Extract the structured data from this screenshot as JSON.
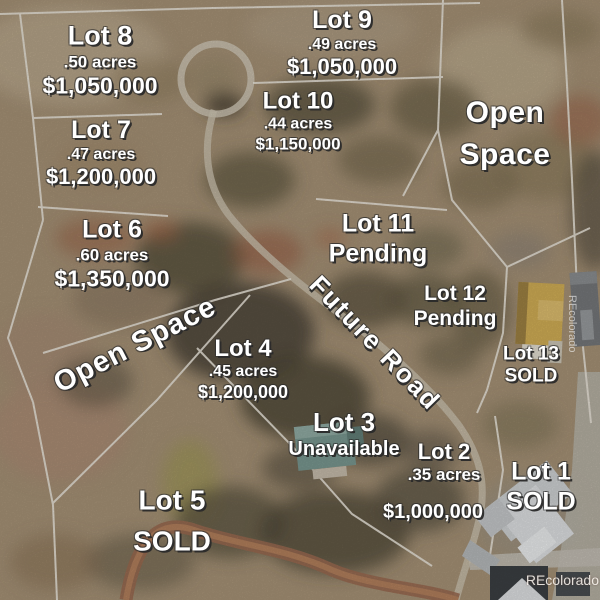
{
  "map": {
    "lots": [
      {
        "label": "Lot 8",
        "detail": ".50 acres",
        "price": "$1,050,000"
      },
      {
        "label": "Lot 9",
        "detail": ".49 acres",
        "price": "$1,050,000"
      },
      {
        "label": "Lot 10",
        "detail": ".44 acres",
        "price": "$1,150,000"
      },
      {
        "label": "Lot 7",
        "detail": ".47 acres",
        "price": "$1,200,000"
      },
      {
        "label": "Lot 6",
        "detail": ".60 acres",
        "price": "$1,350,000"
      },
      {
        "label": "Lot 11",
        "detail": "Pending",
        "price": ""
      },
      {
        "label": "Lot 12",
        "detail": "Pending",
        "price": ""
      },
      {
        "label": "Lot 13",
        "detail": "SOLD",
        "price": ""
      },
      {
        "label": "Lot 4",
        "detail": ".45 acres",
        "price": "$1,200,000"
      },
      {
        "label": "Lot 3",
        "detail": "Unavailable",
        "price": ""
      },
      {
        "label": "Lot 2",
        "detail": ".35 acres",
        "price": "$1,000,000"
      },
      {
        "label": "Lot 1",
        "detail": "SOLD",
        "price": ""
      },
      {
        "label": "Lot 5",
        "detail": "SOLD",
        "price": ""
      }
    ],
    "open_space_top_right": "Open Space",
    "open_space_left": "Open Space",
    "future_road_label": "Future Road",
    "watermark": "REcolorado",
    "colors": {
      "label_text": "#ffffff",
      "label_shadow": "#2a2a2a",
      "boundary_line": "#ece7dc",
      "terrain_base": "#a89478",
      "dirt_road": "#9c6c52",
      "pavement": "#bcb8ae",
      "yellow_building": "#d4b157",
      "gray_building": "#77797c",
      "teal_roof": "#7b9a92",
      "house_roof": "#d8dbdd"
    }
  }
}
